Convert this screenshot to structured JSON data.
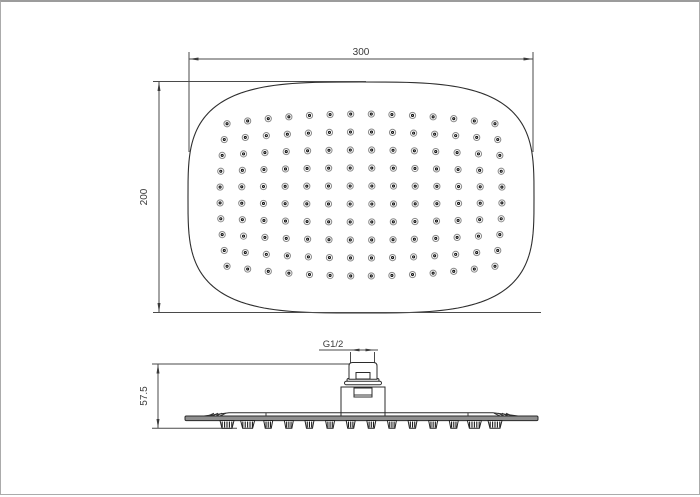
{
  "labels": {
    "top_width": "300",
    "top_height": "200",
    "side_height": "57.5",
    "thread": "G1/2"
  },
  "colors": {
    "line": "#2e2e2e",
    "dim": "#4a4a4a",
    "plate_fill": "#8f8f8f",
    "nozzle_ring": "#8a8a8a",
    "nozzle_dot": "#141414",
    "background": "#ffffff"
  },
  "top_view": {
    "shape": {
      "cx": 360,
      "cy": 195.5,
      "half_w": 173,
      "half_h": 115.5,
      "exponent": 3.4
    },
    "nozzle_grid": {
      "rows": 10,
      "cols": 14,
      "total_nozzles": 140,
      "center_x": 360,
      "center_y": 193,
      "half_width": 141,
      "half_height": 81,
      "barrel_x": 0.05,
      "barrel_y": 0.12,
      "outer_radius": 3.1,
      "dot_radius": 1.55,
      "pin_radius": 0.45
    }
  },
  "side_view": {
    "nozzle_columns": 14,
    "span_left": 226,
    "span_right": 494,
    "top_y": 418.5,
    "bottom_y": 426.3
  }
}
